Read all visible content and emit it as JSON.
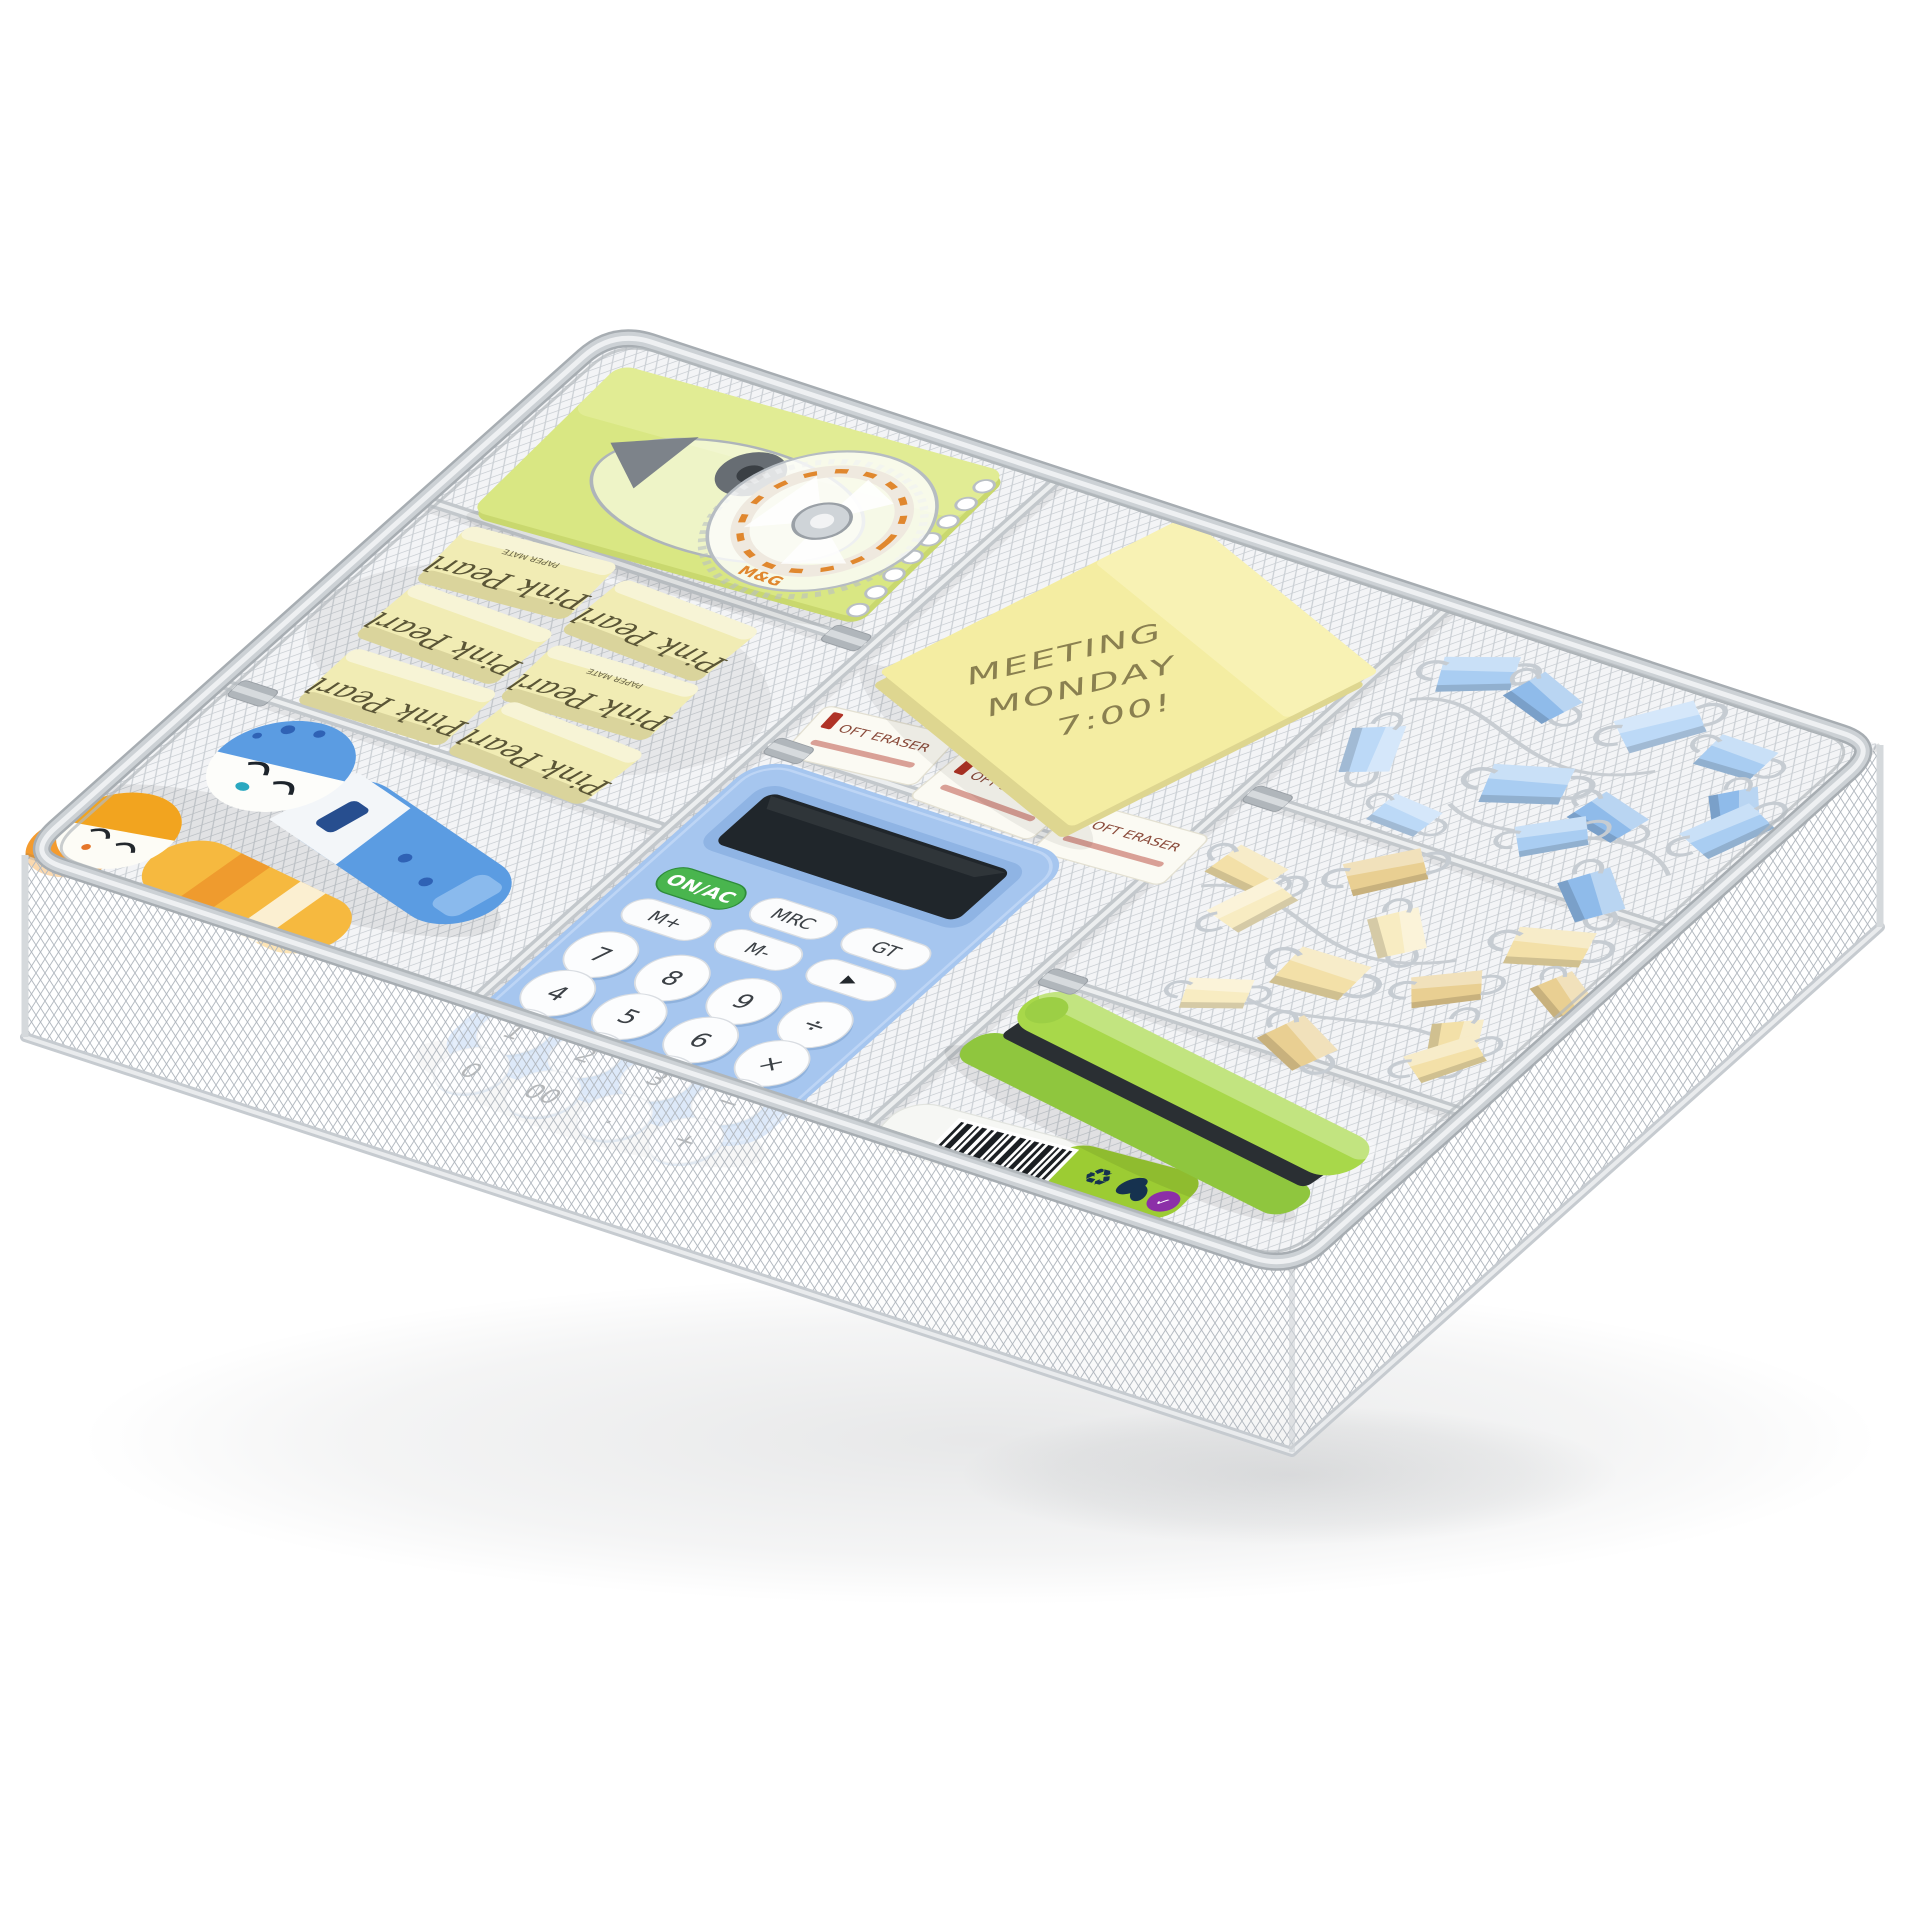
{
  "scene": {
    "background_color": "#ffffff",
    "subject": "silver mesh drawer organizer tray with office supplies"
  },
  "tray": {
    "frame_color": "#ccd1d5",
    "mesh_color": "#c9ced3"
  },
  "notebook": {
    "color": "#d9e783"
  },
  "correction_tape": {
    "brand": "M&G",
    "accent_color": "#e0872e"
  },
  "cream_erasers": {
    "script_label": "Pink Pearl",
    "brand_label": "PAPER MATE",
    "color": "#f1ecb4",
    "count": 6
  },
  "white_erasers": {
    "label": "OFT ERASER",
    "color": "#fbfaf3",
    "count": 3
  },
  "sticky_note": {
    "color": "#f4eda2",
    "lines": [
      "MEETING",
      "MONDAY",
      "7:00!"
    ]
  },
  "calculator": {
    "body_color": "#a6c6ef",
    "power_label": "ON/AC",
    "power_color": "#49b54e",
    "mrc": "MRC",
    "gt": "GT",
    "m_plus": "M+",
    "m_minus": "M-",
    "arrow": "▶",
    "round_buttons": [
      "7",
      "8",
      "9",
      "÷",
      "4",
      "5",
      "6",
      "×",
      "1",
      "2",
      "3",
      "−",
      "0",
      "00",
      ".",
      "+"
    ]
  },
  "binder_clips": {
    "blue_color": "#a9cdf2",
    "yellow_color": "#f3e0a8"
  },
  "stapler": {
    "color": "#a8d84a"
  },
  "tube": {
    "label_color": "#9ccc33"
  },
  "dolls": {
    "blue": "#5b9ce2",
    "yellow": "#f6b93f"
  }
}
